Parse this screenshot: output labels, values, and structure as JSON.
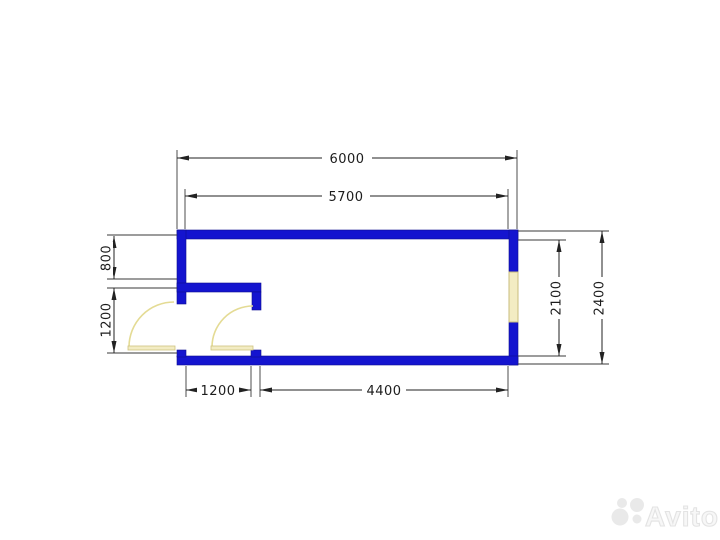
{
  "watermark": {
    "brand": "Avito"
  },
  "plan": {
    "dimensions": {
      "overall_width": "6000",
      "inner_width": "5700",
      "left_upper": "800",
      "left_door": "1200",
      "inner_height": "2100",
      "overall_height": "2400",
      "bottom_vestibule": "1200",
      "bottom_room": "4400"
    },
    "colors": {
      "wall": "#1414cf",
      "opening_fill": "#f3ecc3",
      "opening_stroke": "#c9bc7c",
      "dimension": "#222222",
      "watermark": "#e9e9e9"
    }
  }
}
